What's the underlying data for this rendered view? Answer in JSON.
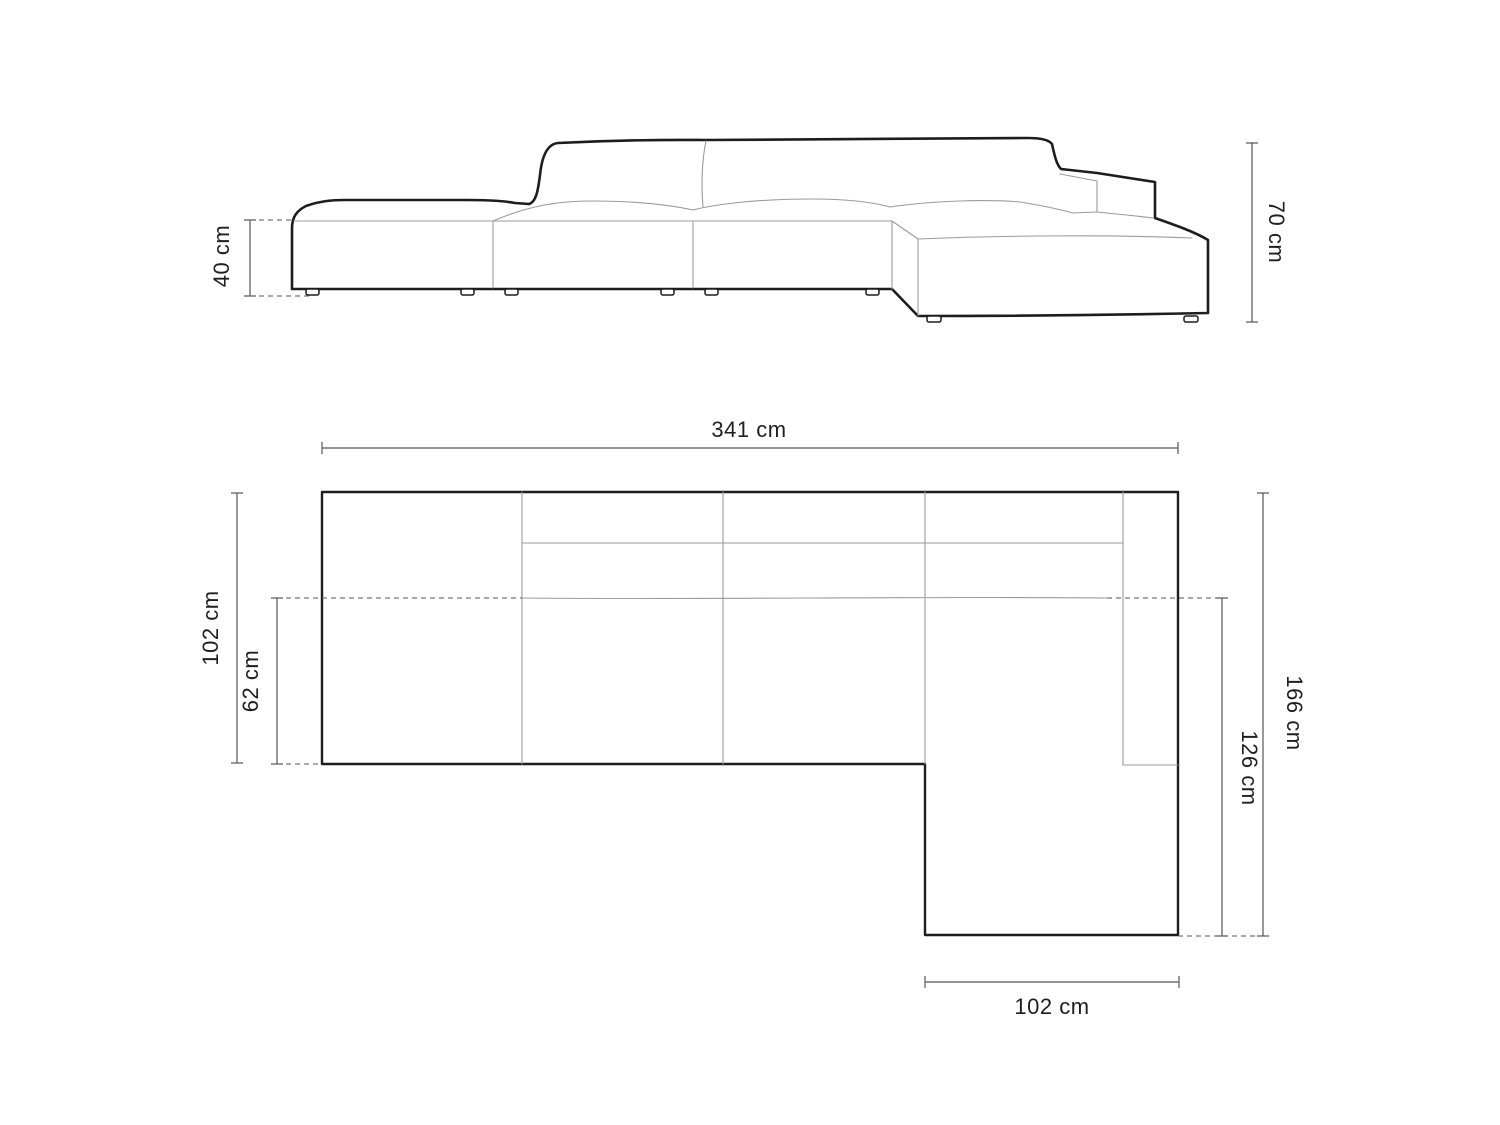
{
  "diagram": {
    "type": "sofa-dimension-drawing",
    "background": "#ffffff",
    "colors": {
      "outline": "#1d1d1d",
      "interior_line": "#9b9b9b",
      "dimension_line": "#555555",
      "label_text": "#1f1f1f"
    },
    "views": {
      "front_elevation": {
        "dimensions": {
          "seat_height": "40 cm",
          "total_height": "70 cm"
        }
      },
      "top_plan": {
        "dimensions": {
          "total_width": "341 cm",
          "total_depth": "102 cm",
          "seat_depth": "62 cm",
          "depth_with_chaise": "166 cm",
          "chaise_length": "126 cm",
          "chaise_width": "102 cm"
        }
      }
    }
  }
}
